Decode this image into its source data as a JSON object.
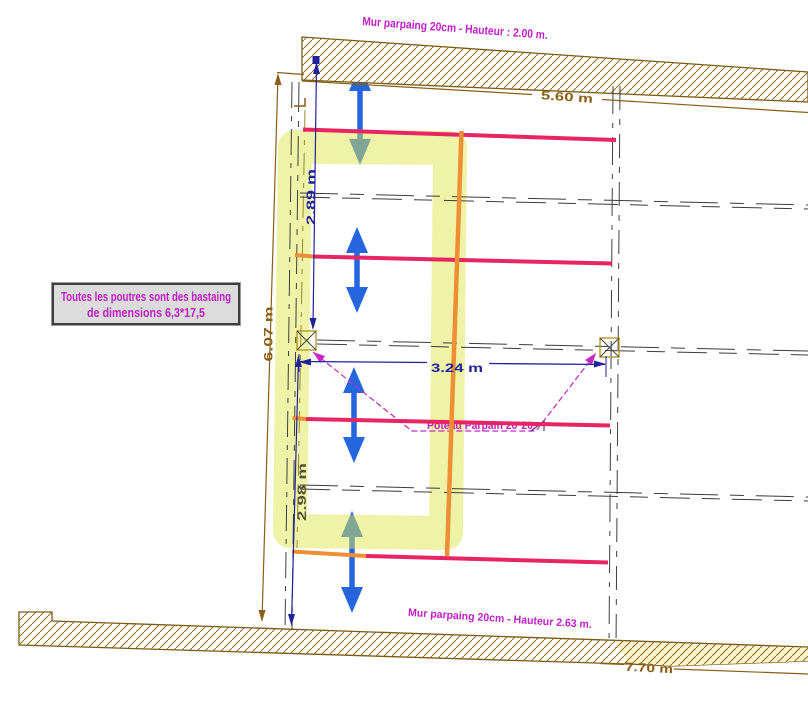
{
  "plan": {
    "top_wall_label": "Mur parpaing 20cm - Hauteur : 2.00 m.",
    "bottom_wall_label": "Mur parpaing 20cm - Hauteur 2.63 m.",
    "post_label": "Poteau Parpain 20*20",
    "note": {
      "line1": "Toutes les poutres sont des bastaing",
      "line2": "de dimensions 6,3*17,5"
    },
    "dimensions": {
      "top_width": "5.60 m",
      "left_height": "6.07 m",
      "upper_bay": "2.89 m",
      "lower_bay": "2.98 m",
      "post_spacing": "3.24 m",
      "bottom_width": "7.70 m"
    },
    "colors": {
      "label_magenta": "#bf1ec6",
      "wall_brown": "#8a5f14",
      "dim_navy": "#22229a",
      "dim_gray": "#53533a",
      "beam_pink": "#e72562",
      "beam_orange": "#ef8f33",
      "arrow_blue": "#2565dd",
      "highlight_yellow": "#e1e955",
      "note_bg": "#dcdcdc"
    }
  }
}
